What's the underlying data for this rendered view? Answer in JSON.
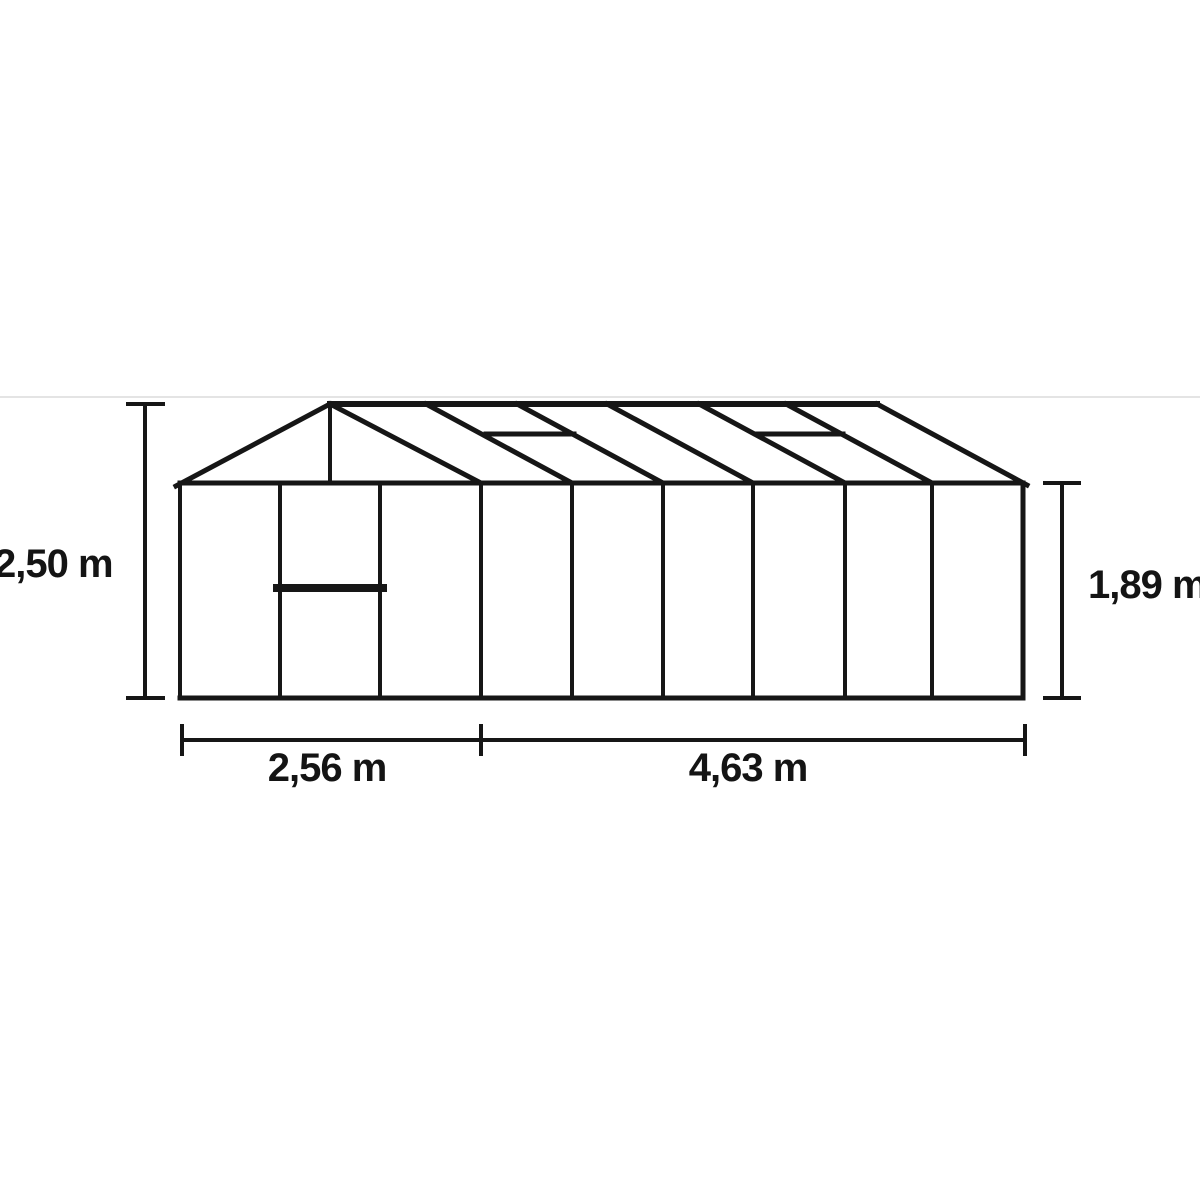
{
  "page": {
    "background": "#ffffff",
    "ink_color": "#161616",
    "faint_line_color": "#e4e4e4"
  },
  "dimensions": {
    "total_height": "2,50 m",
    "side_height": "1,89 m",
    "front_width": "2,56 m",
    "side_length": "4,63 m"
  },
  "diagram": {
    "description": "greenhouse elevation dimension drawing (front gable with door, oblique side view with glazing bars and two roof windows)",
    "lines": [
      {
        "n": "photo-frame-border",
        "x1": 0,
        "y1": 397,
        "x2": 1200,
        "y2": 397,
        "w": 2,
        "c": "#e4e4e4"
      },
      {
        "n": "dim-height-total-line",
        "x1": 145,
        "y1": 404,
        "x2": 145,
        "y2": 698,
        "w": 4
      },
      {
        "n": "dim-height-total-cap-top",
        "x1": 128,
        "y1": 404,
        "x2": 163,
        "y2": 404,
        "w": 4
      },
      {
        "n": "dim-height-total-cap-bottom",
        "x1": 128,
        "y1": 698,
        "x2": 163,
        "y2": 698,
        "w": 4
      },
      {
        "n": "dim-height-side-line",
        "x1": 1062,
        "y1": 483,
        "x2": 1062,
        "y2": 698,
        "w": 4
      },
      {
        "n": "dim-height-side-cap-top",
        "x1": 1045,
        "y1": 483,
        "x2": 1079,
        "y2": 483,
        "w": 4
      },
      {
        "n": "dim-height-side-cap-bottom",
        "x1": 1045,
        "y1": 698,
        "x2": 1079,
        "y2": 698,
        "w": 4
      },
      {
        "n": "dim-width-line",
        "x1": 182,
        "y1": 740,
        "x2": 1025,
        "y2": 740,
        "w": 4
      },
      {
        "n": "dim-width-tick-left",
        "x1": 182,
        "y1": 726,
        "x2": 182,
        "y2": 754,
        "w": 4
      },
      {
        "n": "dim-width-tick-mid",
        "x1": 481,
        "y1": 726,
        "x2": 481,
        "y2": 754,
        "w": 4
      },
      {
        "n": "dim-width-tick-right",
        "x1": 1025,
        "y1": 726,
        "x2": 1025,
        "y2": 754,
        "w": 4
      },
      {
        "n": "eave-line",
        "x1": 180,
        "y1": 483,
        "x2": 1023,
        "y2": 483,
        "w": 5
      },
      {
        "n": "base-line",
        "x1": 180,
        "y1": 698,
        "x2": 1023,
        "y2": 698,
        "w": 5
      },
      {
        "n": "front-left-corner-post",
        "x1": 180,
        "y1": 483,
        "x2": 180,
        "y2": 698,
        "w": 4
      },
      {
        "n": "door-left-post",
        "x1": 280,
        "y1": 483,
        "x2": 280,
        "y2": 698,
        "w": 4
      },
      {
        "n": "door-right-post",
        "x1": 380,
        "y1": 483,
        "x2": 380,
        "y2": 698,
        "w": 4
      },
      {
        "n": "door-mid-rail",
        "x1": 277,
        "y1": 588,
        "x2": 383,
        "y2": 588,
        "w": 8
      },
      {
        "n": "front-right-corner-post",
        "x1": 481,
        "y1": 483,
        "x2": 481,
        "y2": 698,
        "w": 4
      },
      {
        "n": "side-glazing-bar-1",
        "x1": 572,
        "y1": 483,
        "x2": 572,
        "y2": 698,
        "w": 4
      },
      {
        "n": "side-glazing-bar-2",
        "x1": 663,
        "y1": 483,
        "x2": 663,
        "y2": 698,
        "w": 4
      },
      {
        "n": "side-glazing-bar-3",
        "x1": 753,
        "y1": 483,
        "x2": 753,
        "y2": 698,
        "w": 4
      },
      {
        "n": "side-glazing-bar-4",
        "x1": 845,
        "y1": 483,
        "x2": 845,
        "y2": 698,
        "w": 4
      },
      {
        "n": "side-glazing-bar-5",
        "x1": 932,
        "y1": 483,
        "x2": 932,
        "y2": 698,
        "w": 4
      },
      {
        "n": "rear-right-corner-post",
        "x1": 1023,
        "y1": 483,
        "x2": 1023,
        "y2": 698,
        "w": 5
      },
      {
        "n": "gable-left-roof-slope",
        "x1": 176,
        "y1": 486,
        "x2": 330,
        "y2": 404,
        "w": 5
      },
      {
        "n": "gable-right-roof-slope",
        "x1": 330,
        "y1": 404,
        "x2": 481,
        "y2": 483,
        "w": 5
      },
      {
        "n": "gable-apex-post",
        "x1": 330,
        "y1": 404,
        "x2": 330,
        "y2": 483,
        "w": 4
      },
      {
        "n": "ridge-line",
        "x1": 330,
        "y1": 404,
        "x2": 877,
        "y2": 404,
        "w": 6
      },
      {
        "n": "roof-glazing-bar-1",
        "x1": 426,
        "y1": 404,
        "x2": 572,
        "y2": 483,
        "w": 5
      },
      {
        "n": "roof-glazing-bar-2",
        "x1": 517,
        "y1": 404,
        "x2": 663,
        "y2": 483,
        "w": 5
      },
      {
        "n": "roof-glazing-bar-3",
        "x1": 607,
        "y1": 404,
        "x2": 753,
        "y2": 483,
        "w": 5
      },
      {
        "n": "roof-glazing-bar-4",
        "x1": 699,
        "y1": 404,
        "x2": 845,
        "y2": 483,
        "w": 5
      },
      {
        "n": "roof-glazing-bar-5",
        "x1": 786,
        "y1": 404,
        "x2": 932,
        "y2": 483,
        "w": 5
      },
      {
        "n": "roof-end-slope",
        "x1": 877,
        "y1": 404,
        "x2": 1027,
        "y2": 485,
        "w": 5
      },
      {
        "n": "roof-window-1-bottom",
        "x1": 486,
        "y1": 434,
        "x2": 574,
        "y2": 434,
        "w": 5
      },
      {
        "n": "roof-window-2-bottom",
        "x1": 756,
        "y1": 434,
        "x2": 843,
        "y2": 434,
        "w": 5
      }
    ]
  }
}
